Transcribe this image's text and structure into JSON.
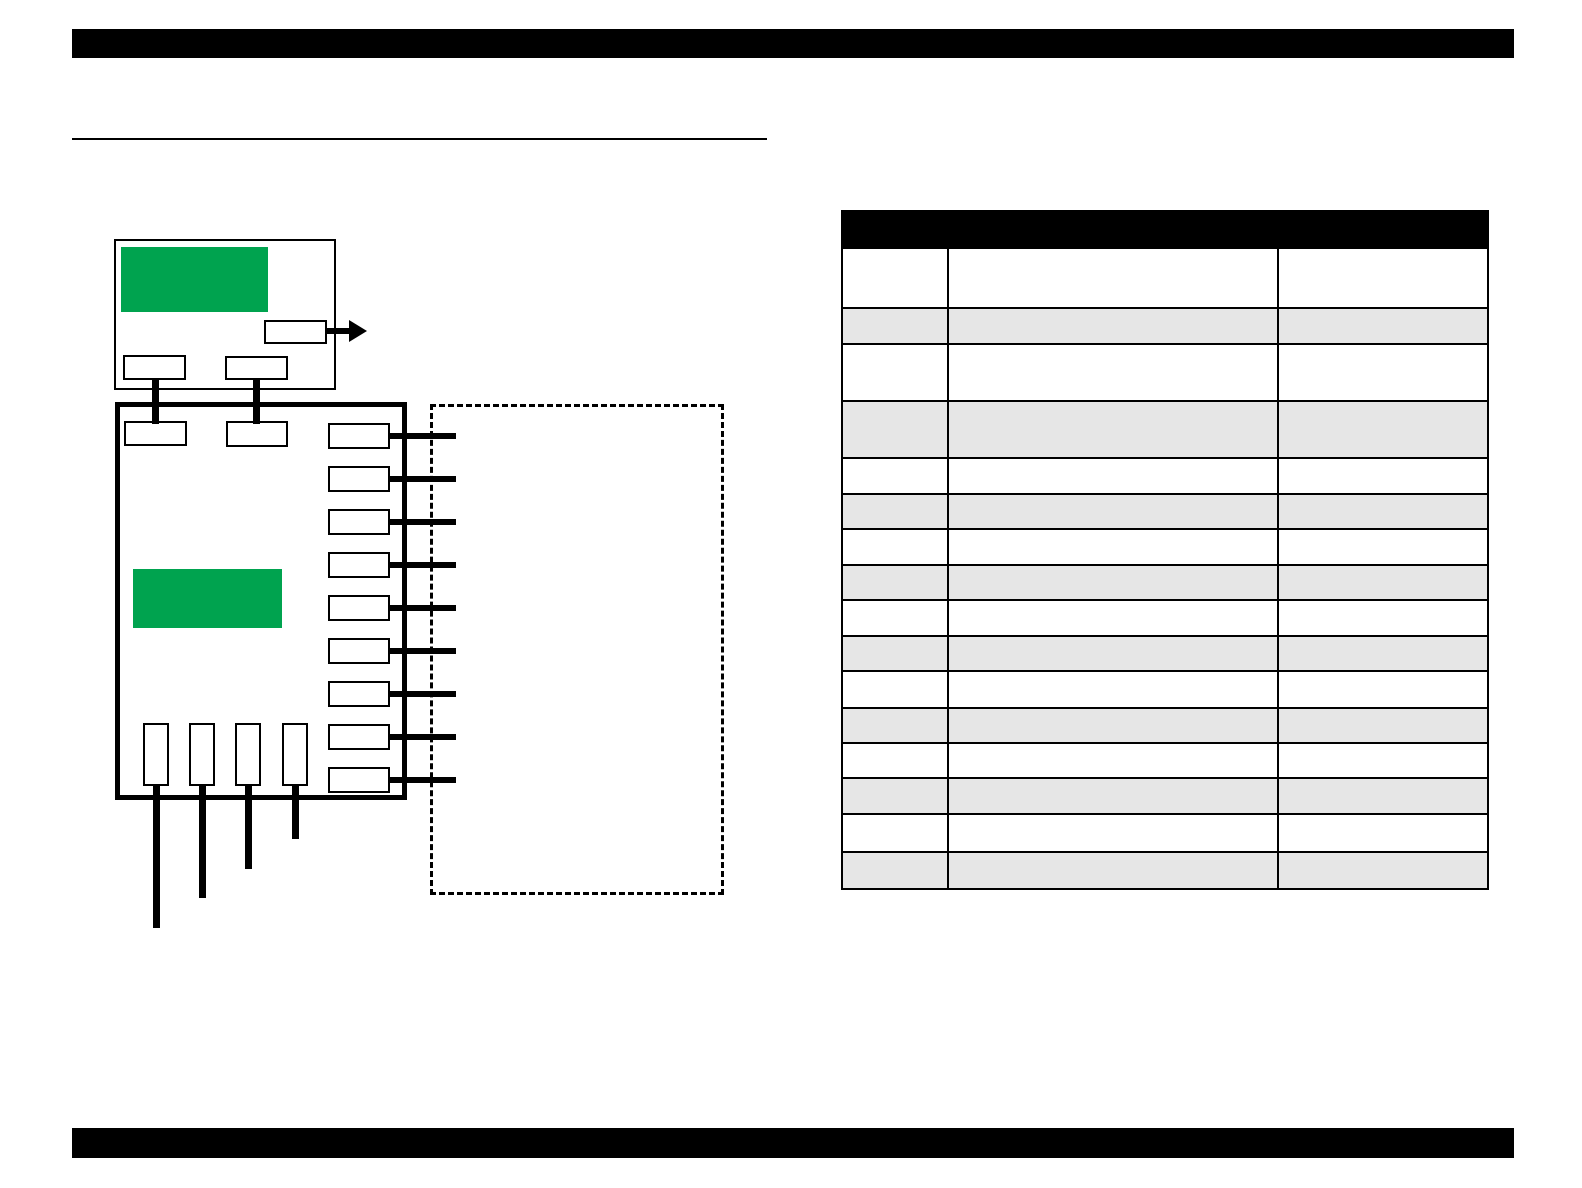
{
  "page": {
    "background": "#ffffff"
  },
  "colors": {
    "ink": "#000000",
    "accent_green": "#00A34F",
    "row_shade": "#E6E6E6",
    "paper": "#ffffff"
  },
  "header": {
    "bar_present": true,
    "title_text": ""
  },
  "footer": {
    "bar_present": true,
    "text": ""
  },
  "section": {
    "title_rule_present": true,
    "title_text": ""
  },
  "diagram": {
    "upper_unit": {
      "green_panel": true,
      "output_port_count": 1,
      "bottom_port_count": 2,
      "labels": []
    },
    "main_unit": {
      "green_panel": true,
      "top_port_count": 2,
      "labels": []
    },
    "right_ports": {
      "count": 9,
      "box_x": 328,
      "start_y": 423,
      "spacing": 43,
      "box_w": 62,
      "box_h": 26,
      "line_x": 386,
      "line_w": 70,
      "line_h": 6
    },
    "bottom_ports": {
      "box_y": 723,
      "box_w": 26,
      "box_h": 63,
      "line_w": 7,
      "line_top": 783,
      "items": [
        {
          "x": 143,
          "line_end_y": 928
        },
        {
          "x": 189,
          "line_end_y": 898
        },
        {
          "x": 235,
          "line_end_y": 869
        },
        {
          "x": 282,
          "line_end_y": 839
        }
      ]
    },
    "dashed_region": {
      "present": true,
      "label": ""
    }
  },
  "table": {
    "header_text": "",
    "header_height": 37,
    "columns": 3,
    "col_widths": [
      106,
      330,
      212
    ],
    "rows": [
      {
        "h": 58,
        "shaded": false,
        "cells": [
          "",
          "",
          ""
        ]
      },
      {
        "h": 36,
        "shaded": true,
        "cells": [
          "",
          "",
          ""
        ]
      },
      {
        "h": 57,
        "shaded": false,
        "cells": [
          "",
          "",
          ""
        ]
      },
      {
        "h": 57,
        "shaded": true,
        "cells": [
          "",
          "",
          ""
        ]
      },
      {
        "h": 36,
        "shaded": false,
        "cells": [
          "",
          "",
          ""
        ]
      },
      {
        "h": 35,
        "shaded": true,
        "cells": [
          "",
          "",
          ""
        ]
      },
      {
        "h": 36,
        "shaded": false,
        "cells": [
          "",
          "",
          ""
        ]
      },
      {
        "h": 35,
        "shaded": true,
        "cells": [
          "",
          "",
          ""
        ]
      },
      {
        "h": 36,
        "shaded": false,
        "cells": [
          "",
          "",
          ""
        ]
      },
      {
        "h": 35,
        "shaded": true,
        "cells": [
          "",
          "",
          ""
        ]
      },
      {
        "h": 37,
        "shaded": false,
        "cells": [
          "",
          "",
          ""
        ]
      },
      {
        "h": 35,
        "shaded": true,
        "cells": [
          "",
          "",
          ""
        ]
      },
      {
        "h": 35,
        "shaded": false,
        "cells": [
          "",
          "",
          ""
        ]
      },
      {
        "h": 36,
        "shaded": true,
        "cells": [
          "",
          "",
          ""
        ]
      },
      {
        "h": 38,
        "shaded": false,
        "cells": [
          "",
          "",
          ""
        ]
      },
      {
        "h": 37,
        "shaded": true,
        "cells": [
          "",
          "",
          ""
        ]
      }
    ]
  }
}
